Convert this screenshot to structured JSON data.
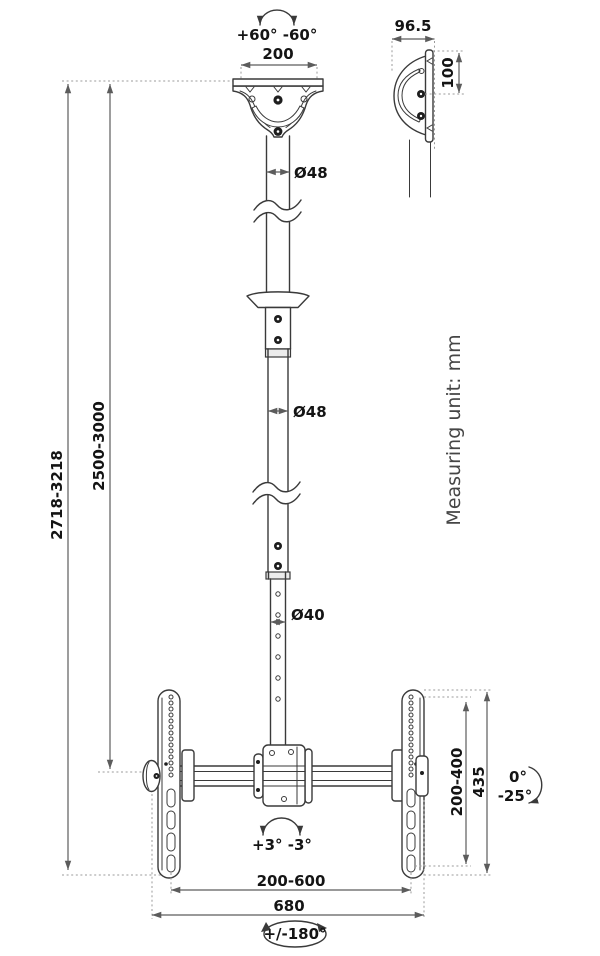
{
  "diagram": {
    "unit_note": "Measuring unit: mm",
    "ceiling_mount": {
      "swivel_label": "+60° -60°",
      "plate_width": "200",
      "side_depth": "96.5",
      "side_hole_spacing": "100"
    },
    "pole": {
      "upper_diameter": "Ø48",
      "middle_diameter": "Ø48",
      "lower_diameter": "Ø40",
      "overall_height_range": "2718-3218",
      "pole_height_range": "2500-3000"
    },
    "tv_bracket": {
      "vesa_height_range": "200-400",
      "plate_height": "435",
      "tilt_up": "0°",
      "tilt_down": "-25°",
      "level_adjust": "+3° -3°",
      "vesa_width_range": "200-600",
      "total_width": "680",
      "swivel_label": "+/-180°"
    }
  },
  "colors": {
    "background": "#ffffff",
    "outline": "#3a3a3a",
    "dimension": "#5c5c5c",
    "dotted": "#9b9b9b",
    "text": "#141414",
    "note": "#454545"
  }
}
